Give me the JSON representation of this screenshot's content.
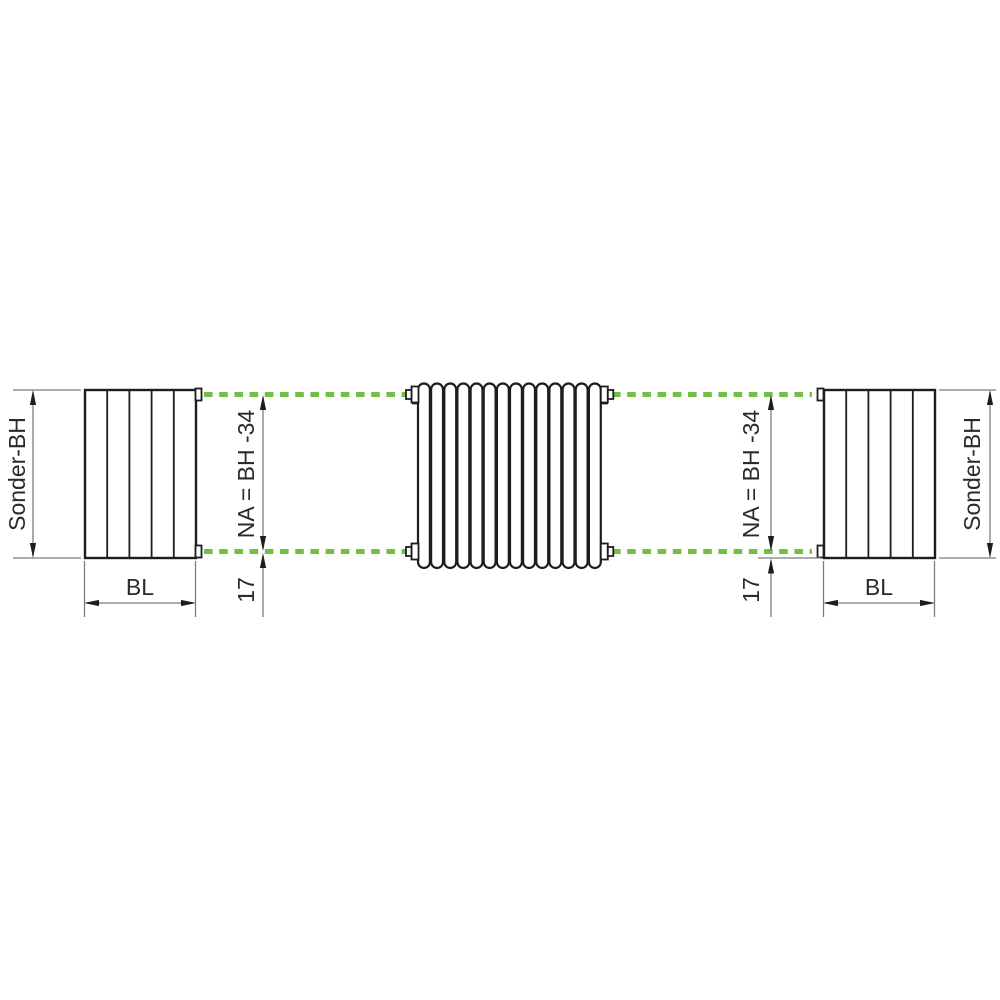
{
  "diagram_title": "radiator-nipple-connection-dimension-diagram",
  "labels": {
    "special_height": "Sonder-BH",
    "build_length": "BL",
    "nipple_distance": "NA = BH -34",
    "nipple_edge_offset": "17"
  },
  "colors": {
    "outline": "#1d1d1b",
    "dimension_line": "#7c7c7c",
    "text": "#2a2a29",
    "accent_green": "#72bf44",
    "background": "#ffffff"
  }
}
